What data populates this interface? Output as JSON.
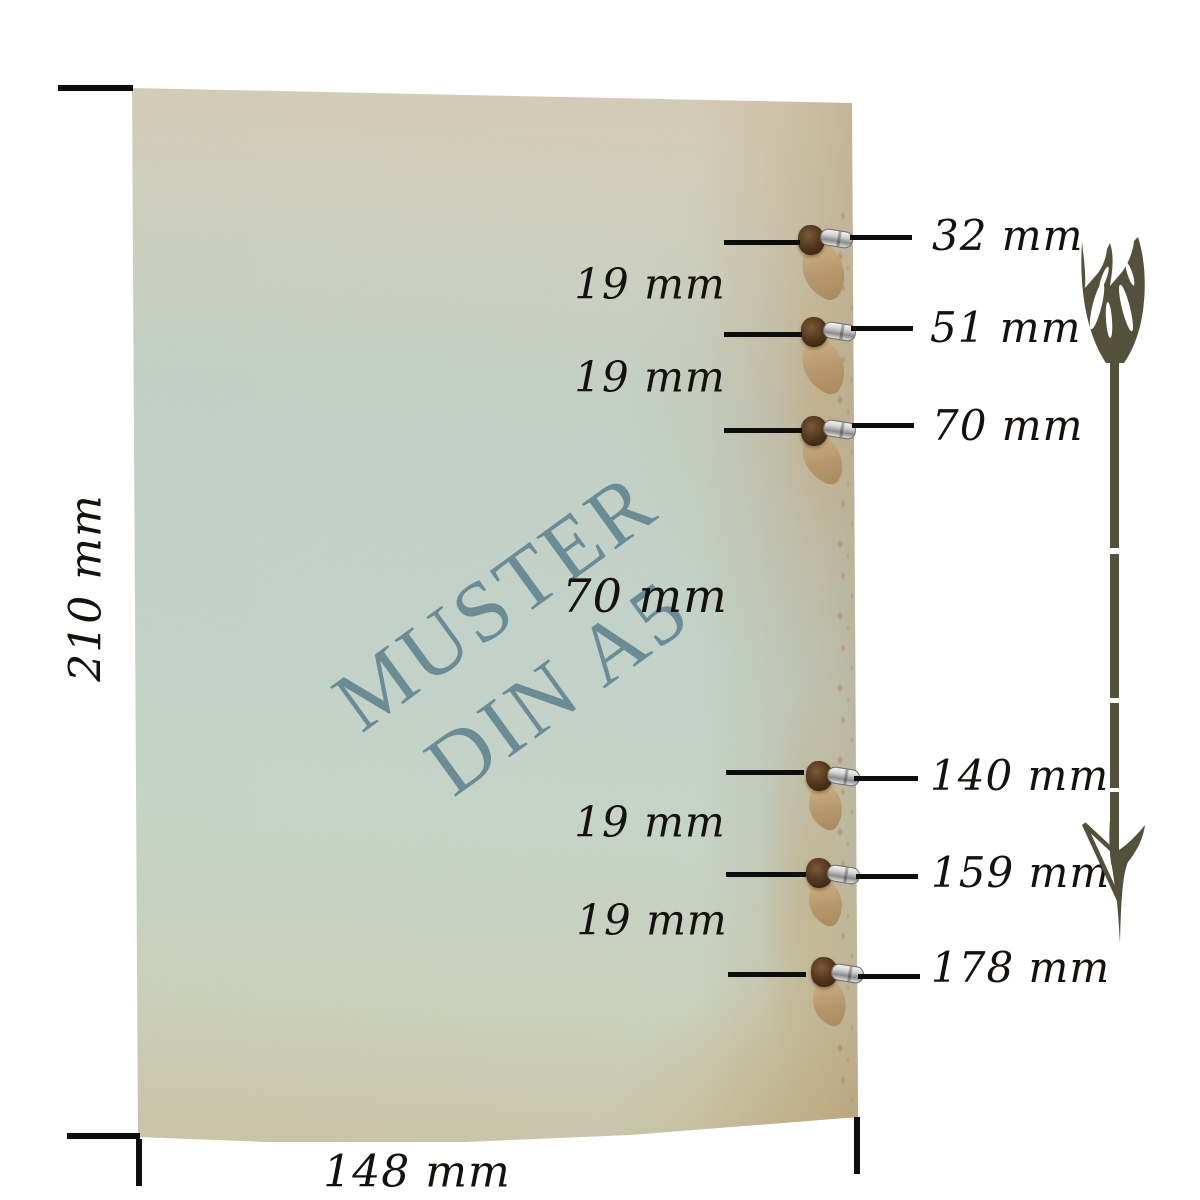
{
  "watermark": {
    "line1": "MUSTER",
    "line2": "DIN A5",
    "color": "#5f828c"
  },
  "sheet": {
    "height_label": "210 mm",
    "width_label": "148 mm"
  },
  "hole_labels": [
    "32 mm",
    "51 mm",
    "70 mm",
    "140 mm",
    "159 mm",
    "178 mm"
  ],
  "gap_labels": [
    "19 mm",
    "19 mm",
    "70 mm",
    "19 mm",
    "19 mm"
  ],
  "icons": {
    "length_arrow": "feathered-arrow-down-icon"
  },
  "colors": {
    "dimension_line": "#0d0d0d",
    "arrow": "#53503c",
    "paper_top": "#d7cdb7",
    "paper_middle": "#c3d5ce",
    "paper_bottom": "#cbc5a9",
    "kraft_tear": "#b5946a",
    "metal_ring": "#cfcfcf"
  }
}
